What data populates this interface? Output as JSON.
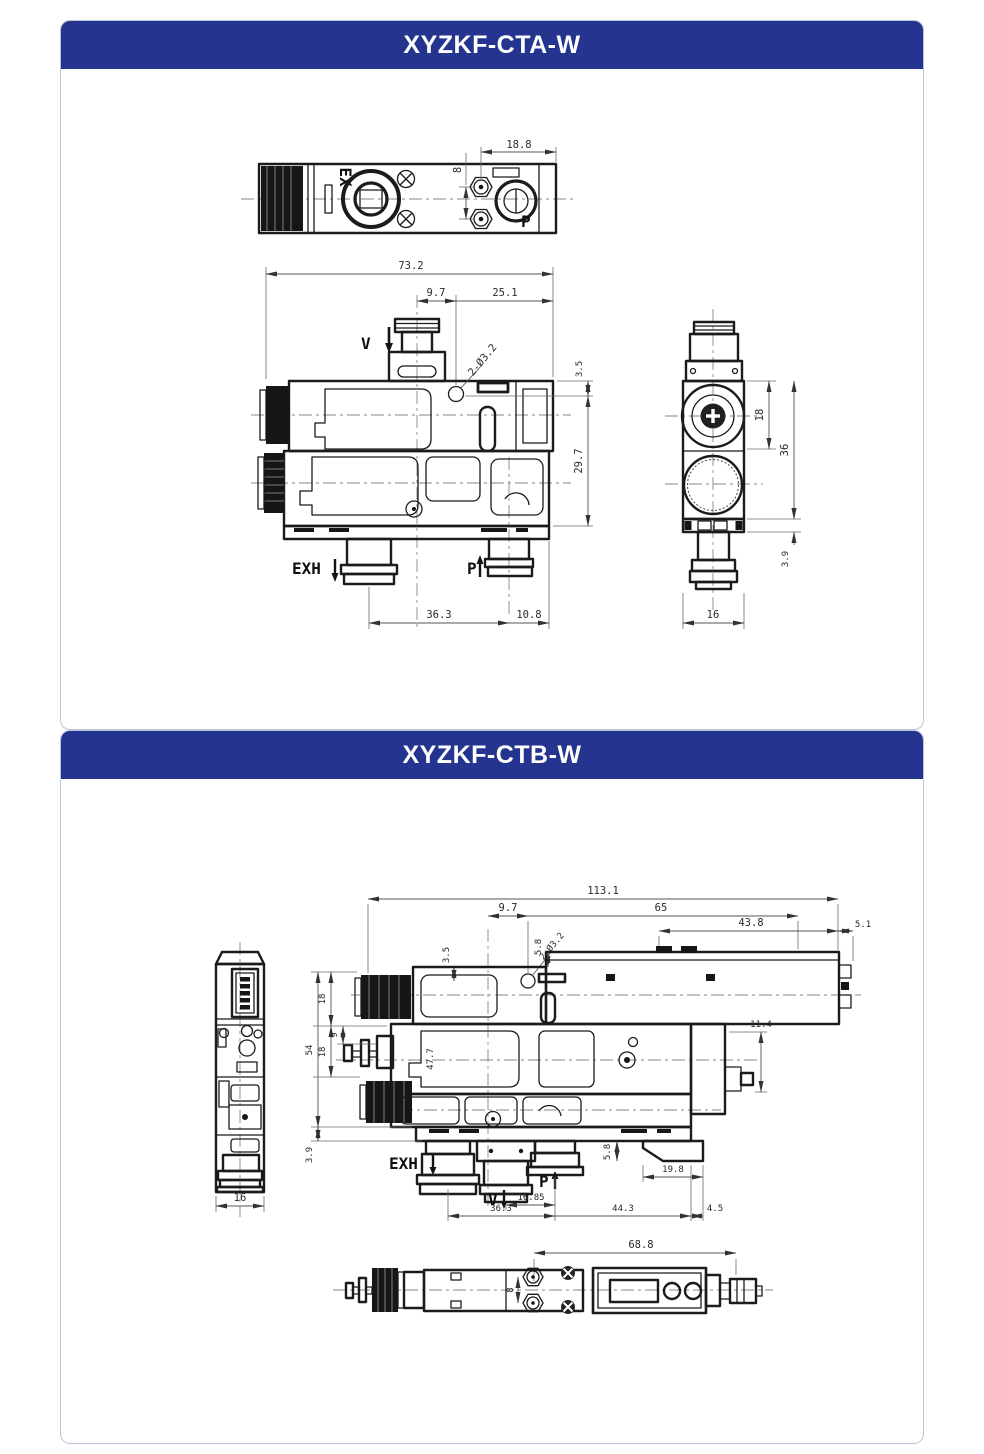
{
  "colors": {
    "accent": "#24348F",
    "panel_border": "#b9c6da",
    "line": "#1b1b1b"
  },
  "panelA": {
    "title": "XYZKF-CTA-W",
    "top_view": {
      "dim_height": "8",
      "dim_width": "18.8",
      "label_ex": "EX",
      "label_p": "P"
    },
    "front_view": {
      "dim_total": "73.2",
      "dim_offset": "9.7",
      "dim_right": "25.1",
      "hole_note": "2-Ø3.2",
      "dim_top": "3.5",
      "dim_height": "29.7",
      "dim_exh_p": "36.3",
      "dim_p_edge": "10.8",
      "label_v": "V",
      "label_exh": "EXH",
      "label_p": "P"
    },
    "side_view": {
      "dim_upper": "18",
      "dim_body": "36",
      "dim_base": "3.9",
      "dim_width": "16"
    }
  },
  "panelB": {
    "title": "XYZKF-CTB-W",
    "side_view": {
      "dim_width": "16"
    },
    "front_view": {
      "dim_total": "113.1",
      "dim_offset": "9.7",
      "dim_module": "65",
      "dim_module_body": "43.8",
      "dim_module_edge": "5.1",
      "dim_top": "3.5",
      "hole_note": "2-Ø3.2",
      "dim_step_top": "5.8",
      "dim_h_upper": "18",
      "dim_h_total": "54",
      "dim_h_mid9": "9",
      "dim_h_mid18": "18",
      "dim_base": "3.9",
      "dim_inner": "47.7",
      "dim_stub": "11.4",
      "dim_foot": "5.8",
      "dim_bracket": "19.8",
      "dim_v_p": "16.85",
      "dim_exh_p": "36.3",
      "dim_p_right": "44.3",
      "dim_edge": "4.5",
      "label_exh": "EXH",
      "label_v": "V",
      "label_p": "P"
    },
    "bottom_view": {
      "dim_length": "68.8",
      "dim_ports": "8"
    }
  }
}
